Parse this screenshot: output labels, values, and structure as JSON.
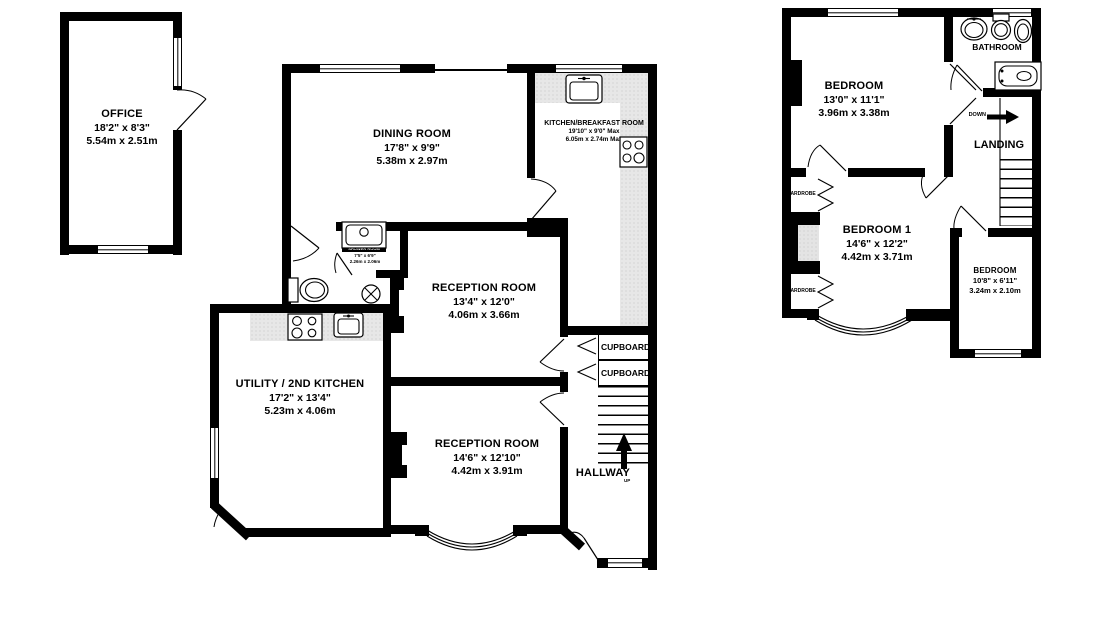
{
  "plan": {
    "rooms": {
      "office": {
        "name": "OFFICE",
        "imperial": "18'2\" x 8'3\"",
        "metric": "5.54m x 2.51m"
      },
      "dining": {
        "name": "DINING ROOM",
        "imperial": "17'8\" x 9'9\"",
        "metric": "5.38m x 2.97m"
      },
      "kitchen": {
        "name": "KITCHEN/BREAKFAST ROOM",
        "imperial": "19'10\" x 9'0\" Max",
        "metric": "6.05m x 2.74m Max"
      },
      "shower": {
        "name": "SHOWER ROOM",
        "imperial": "7'5\" x 6'9\"",
        "metric": "2.26m x 2.06m"
      },
      "reception1": {
        "name": "RECEPTION ROOM",
        "imperial": "13'4\" x 12'0\"",
        "metric": "4.06m x 3.66m"
      },
      "utility": {
        "name": "UTILITY / 2ND KITCHEN",
        "imperial": "17'2\" x 13'4\"",
        "metric": "5.23m x 4.06m"
      },
      "reception2": {
        "name": "RECEPTION ROOM",
        "imperial": "14'6\" x 12'10\"",
        "metric": "4.42m x 3.91m"
      },
      "hallway": {
        "name": "HALLWAY"
      },
      "bedroom_front": {
        "name": "BEDROOM",
        "imperial": "13'0\" x 11'1\"",
        "metric": "3.96m x 3.38m"
      },
      "bathroom": {
        "name": "BATHROOM"
      },
      "landing": {
        "name": "LANDING"
      },
      "bedroom1": {
        "name": "BEDROOM 1",
        "imperial": "14'6\" x 12'2\"",
        "metric": "4.42m x 3.71m"
      },
      "bedroom_small": {
        "name": "BEDROOM",
        "imperial": "10'8\" x 6'11\"",
        "metric": "3.24m x 2.10m"
      }
    },
    "labels": {
      "cupboard": "CUPBOARD",
      "wardrobe": "WARDROBE",
      "up": "UP",
      "down": "DOWN"
    },
    "colors": {
      "wall": "#000000",
      "counter": "#e7e7e7",
      "background": "#ffffff"
    }
  }
}
